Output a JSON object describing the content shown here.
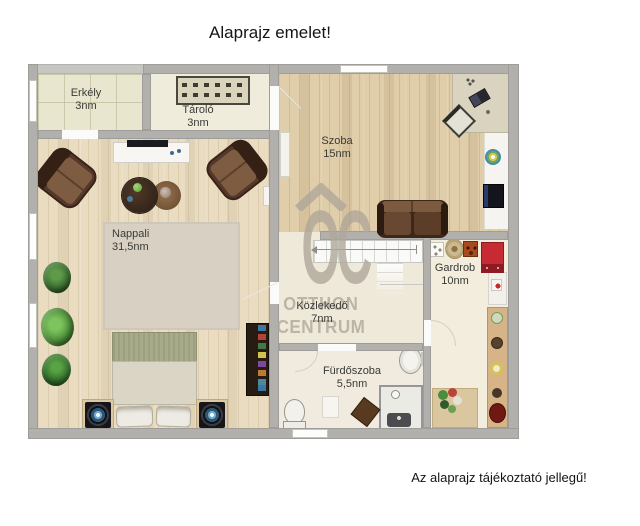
{
  "page": {
    "title": "Alaprajz emelet!",
    "disclaimer": "Az alaprajz tájékoztató jellegű!"
  },
  "watermark": {
    "monogram": "OC",
    "line1": "OTTHON",
    "line2": "CENTRUM"
  },
  "rooms": {
    "erkely": {
      "name": "Erkély",
      "area": "3nm"
    },
    "tarolo": {
      "name": "Tároló",
      "area": "3nm"
    },
    "szoba": {
      "name": "Szoba",
      "area": "15nm"
    },
    "nappali": {
      "name": "Nappali",
      "area": "31,5nm"
    },
    "kozlekedo": {
      "name": "Közlekedő",
      "area": "7nm"
    },
    "gardrob": {
      "name": "Gardrob",
      "area": "10nm"
    },
    "furdoszoba": {
      "name": "Fürdőszoba",
      "area": "5,5nm"
    }
  },
  "colors": {
    "wall": "#b1b0ac",
    "wood_floor": "#e0cda9",
    "tile_floor": "#e9e6cf",
    "cream_floor": "#f0ebdc",
    "rug": "#d8d1c3",
    "bed_headboard": "#a8ab8a",
    "armchair_brown": "#54382a",
    "wardrobe_red": "#c62b34",
    "watermark_gray": "#b0a89a"
  }
}
